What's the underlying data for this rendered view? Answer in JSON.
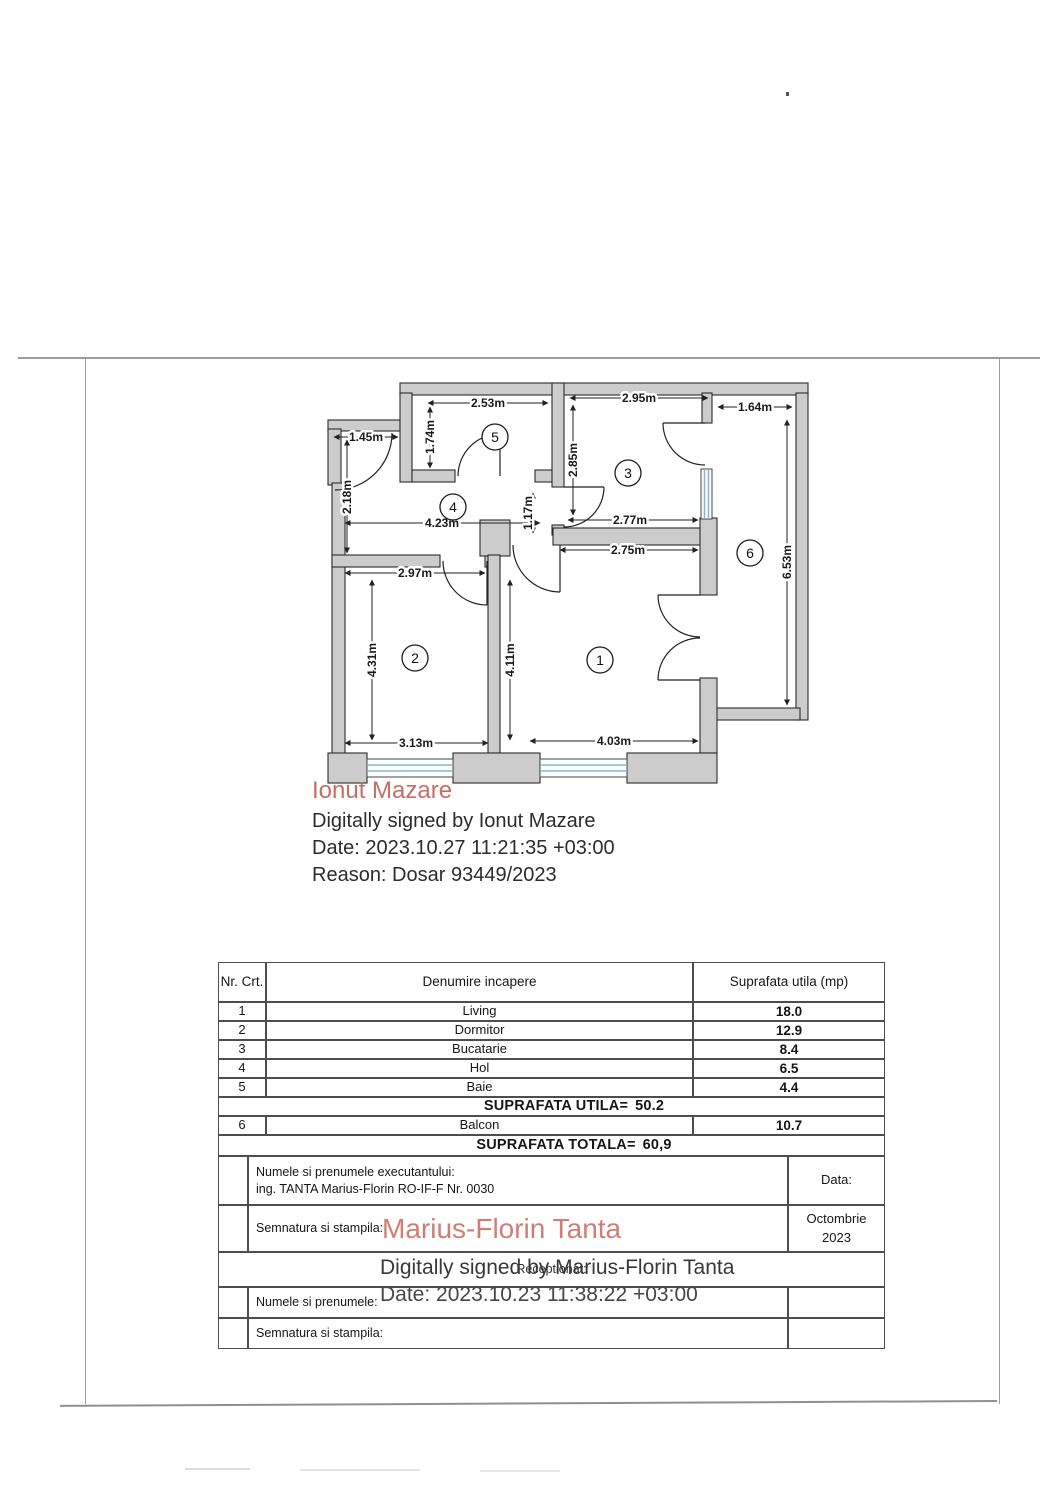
{
  "signature_top": {
    "name": "Ionut Mazare",
    "signed": "Digitally signed by Ionut Mazare",
    "date": "Date: 2023.10.27 11:21:35 +03:00",
    "reason": "Reason: Dosar 93449/2023"
  },
  "signature_bottom": {
    "name": "Marius-Florin Tanta",
    "signed": "Digitally signed by Marius-Florin Tanta",
    "date": "Date: 2023.10.23 11:38:22 +03:00"
  },
  "floorplan": {
    "room_numbers": [
      "1",
      "2",
      "3",
      "4",
      "5",
      "6"
    ],
    "dims": [
      "2.53m",
      "2.95m",
      "1.64m",
      "1.45m",
      "1.74m",
      "2.85m",
      "2.18m",
      "4.23m",
      "1.17m",
      "2.77m",
      "2.75m",
      "6.53m",
      "2.97m",
      "4.31m",
      "4.11m",
      "3.13m",
      "4.03m"
    ]
  },
  "table": {
    "header": {
      "nr": "Nr. Crt.",
      "name": "Denumire incapere",
      "area": "Suprafata utila (mp)"
    },
    "rows": [
      {
        "nr": "1",
        "name": "Living",
        "area": "18.0"
      },
      {
        "nr": "2",
        "name": "Dormitor",
        "area": "12.9"
      },
      {
        "nr": "3",
        "name": "Bucatarie",
        "area": "8.4"
      },
      {
        "nr": "4",
        "name": "Hol",
        "area": "6.5"
      },
      {
        "nr": "5",
        "name": "Baie",
        "area": "4.4"
      }
    ],
    "utila": {
      "label": "SUPRAFATA UTILA=",
      "value": "50.2"
    },
    "balcon": {
      "nr": "6",
      "name": "Balcon",
      "area": "10.7"
    },
    "totala": {
      "label": "SUPRAFATA TOTALA=",
      "value": "60,9"
    },
    "executant_label": "Numele si prenumele executantului:",
    "executant_value": "ing. TANTA Marius-Florin RO-IF-F Nr. 0030",
    "data_label": "Data:",
    "semnatura_label": "Semnatura si stampila:",
    "date_month": "Octombrie",
    "date_year": "2023",
    "receptionat_label": "Receptionat:",
    "numele_label": "Numele si prenumele:",
    "semnatura2_label": "Semnatura si stampila:"
  },
  "colors": {
    "signature_red_top": "#bf5f52",
    "signature_red_bottom": "#cc7466",
    "window_blue": "#8fb0d6",
    "wall_gray": "#cccccc"
  }
}
